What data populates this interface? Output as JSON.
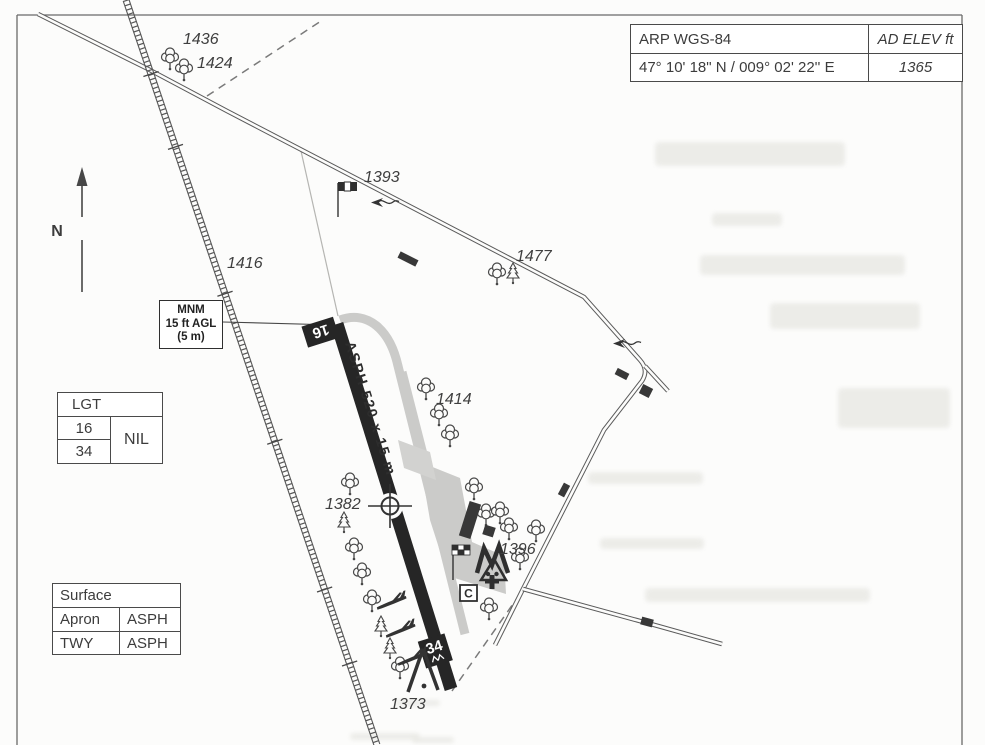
{
  "info_table": {
    "arp_label": "ARP WGS-84",
    "ad_elev_label": "AD ELEV ft",
    "arp_coordinates": "47° 10' 18\" N / 009° 02' 22'' E",
    "ad_elevation": "1365"
  },
  "mnm_box": {
    "line1": "MNM",
    "line2": "15 ft AGL",
    "line3": "(5 m)"
  },
  "lgt_table": {
    "title": "LGT",
    "rwy_a": "16",
    "rwy_b": "34",
    "value": "NIL"
  },
  "surface_table": {
    "title": "Surface",
    "rows": [
      {
        "item": "Apron",
        "value": "ASPH"
      },
      {
        "item": "TWY",
        "value": "ASPH"
      }
    ]
  },
  "north_arrow": {
    "label": "N"
  },
  "runway": {
    "designator_16": "16",
    "designator_34": "34",
    "dimensions_label": "ASPH 520 x 15 m"
  },
  "spot_elevations": {
    "e1436": "1436",
    "e1424": "1424",
    "e1393": "1393",
    "e1477": "1477",
    "e1416": "1416",
    "e1414": "1414",
    "e1382": "1382",
    "e1396": "1396",
    "e1373": "1373"
  },
  "customs": {
    "label": "C"
  },
  "colors": {
    "paper": "#fcfcfb",
    "ink": "#3c3c3c",
    "runway": "#262626",
    "apron_gray": "#cbcbc9",
    "table_border": "#4a4a4a"
  }
}
